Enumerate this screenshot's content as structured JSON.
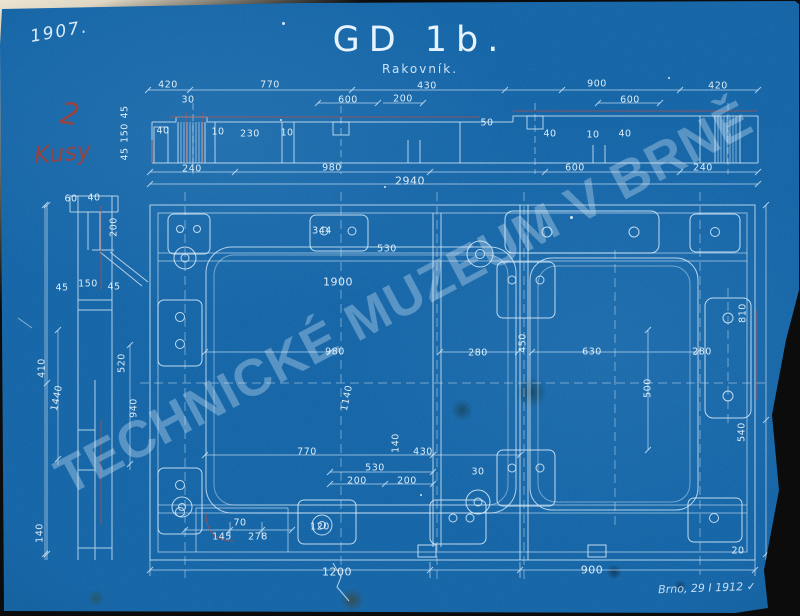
{
  "document": {
    "title": "GD 1b.",
    "subtitle": "Rakovník.",
    "year_note": "1907.",
    "quantity_note": {
      "line1": "2",
      "line2": "Kusy"
    },
    "date_note": "Brno, 29 I 1912 ✓",
    "watermark": "TECHNICKÉ MUZEUM V BRNĚ"
  },
  "colors": {
    "paper_blue": "#1163a6",
    "line_white": "#ddeefb",
    "annotation_red": "#a83f33",
    "backdrop_light": "#ece5d2",
    "backdrop_dark": "#0c0c0c"
  },
  "dimension_labels": [
    {
      "t": "420",
      "x": 168,
      "y": 85
    },
    {
      "t": "770",
      "x": 270,
      "y": 85
    },
    {
      "t": "430",
      "x": 427,
      "y": 86
    },
    {
      "t": "900",
      "x": 597,
      "y": 84
    },
    {
      "t": "420",
      "x": 718,
      "y": 86
    },
    {
      "t": "30",
      "x": 188,
      "y": 100
    },
    {
      "t": "600",
      "x": 348,
      "y": 100
    },
    {
      "t": "200",
      "x": 403,
      "y": 99
    },
    {
      "t": "600",
      "x": 630,
      "y": 100
    },
    {
      "t": "40",
      "x": 163,
      "y": 131
    },
    {
      "t": "10",
      "x": 218,
      "y": 132
    },
    {
      "t": "230",
      "x": 250,
      "y": 134
    },
    {
      "t": "10",
      "x": 287,
      "y": 133
    },
    {
      "t": "50",
      "x": 487,
      "y": 123
    },
    {
      "t": "40",
      "x": 550,
      "y": 134
    },
    {
      "t": "10",
      "x": 593,
      "y": 135
    },
    {
      "t": "40",
      "x": 625,
      "y": 134
    },
    {
      "t": "45",
      "x": 125,
      "y": 112,
      "r": -90
    },
    {
      "t": "150",
      "x": 125,
      "y": 133,
      "r": -90
    },
    {
      "t": "45",
      "x": 125,
      "y": 154,
      "r": -90
    },
    {
      "t": "240",
      "x": 192,
      "y": 169
    },
    {
      "t": "980",
      "x": 332,
      "y": 168
    },
    {
      "t": "600",
      "x": 575,
      "y": 168
    },
    {
      "t": "240",
      "x": 703,
      "y": 168
    },
    {
      "t": "2940",
      "x": 410,
      "y": 181,
      "s": 11
    },
    {
      "t": "60",
      "x": 71,
      "y": 199
    },
    {
      "t": "40",
      "x": 94,
      "y": 198
    },
    {
      "t": "200",
      "x": 114,
      "y": 227,
      "r": -90
    },
    {
      "t": "150",
      "x": 88,
      "y": 284
    },
    {
      "t": "45",
      "x": 62,
      "y": 288
    },
    {
      "t": "45",
      "x": 114,
      "y": 287
    },
    {
      "t": "410",
      "x": 42,
      "y": 368,
      "r": -90
    },
    {
      "t": "1440",
      "x": 57,
      "y": 398,
      "r": -78
    },
    {
      "t": "520",
      "x": 122,
      "y": 363,
      "r": -90
    },
    {
      "t": "940",
      "x": 134,
      "y": 408,
      "r": -90
    },
    {
      "t": "140",
      "x": 40,
      "y": 533,
      "r": -90
    },
    {
      "t": "344",
      "x": 322,
      "y": 231
    },
    {
      "t": "530",
      "x": 387,
      "y": 249
    },
    {
      "t": "1900",
      "x": 338,
      "y": 282,
      "s": 11
    },
    {
      "t": "980",
      "x": 335,
      "y": 352
    },
    {
      "t": "280",
      "x": 478,
      "y": 353
    },
    {
      "t": "630",
      "x": 592,
      "y": 352
    },
    {
      "t": "280",
      "x": 702,
      "y": 352
    },
    {
      "t": "450",
      "x": 523,
      "y": 343,
      "r": -90
    },
    {
      "t": "500",
      "x": 648,
      "y": 388,
      "r": -90
    },
    {
      "t": "810",
      "x": 743,
      "y": 313,
      "r": -90
    },
    {
      "t": "540",
      "x": 742,
      "y": 432,
      "r": -90
    },
    {
      "t": "1140",
      "x": 347,
      "y": 398,
      "r": -78
    },
    {
      "t": "140",
      "x": 396,
      "y": 443,
      "r": -90
    },
    {
      "t": "770",
      "x": 307,
      "y": 452
    },
    {
      "t": "430",
      "x": 423,
      "y": 452
    },
    {
      "t": "530",
      "x": 375,
      "y": 468
    },
    {
      "t": "200",
      "x": 357,
      "y": 481
    },
    {
      "t": "200",
      "x": 407,
      "y": 481
    },
    {
      "t": "30",
      "x": 478,
      "y": 472
    },
    {
      "t": "145",
      "x": 222,
      "y": 537
    },
    {
      "t": "278",
      "x": 258,
      "y": 537
    },
    {
      "t": "70",
      "x": 240,
      "y": 523
    },
    {
      "t": "120",
      "x": 320,
      "y": 527
    },
    {
      "t": "1200",
      "x": 337,
      "y": 572,
      "s": 11
    },
    {
      "t": "900",
      "x": 592,
      "y": 570,
      "s": 11
    },
    {
      "t": "20",
      "x": 738,
      "y": 551
    }
  ]
}
